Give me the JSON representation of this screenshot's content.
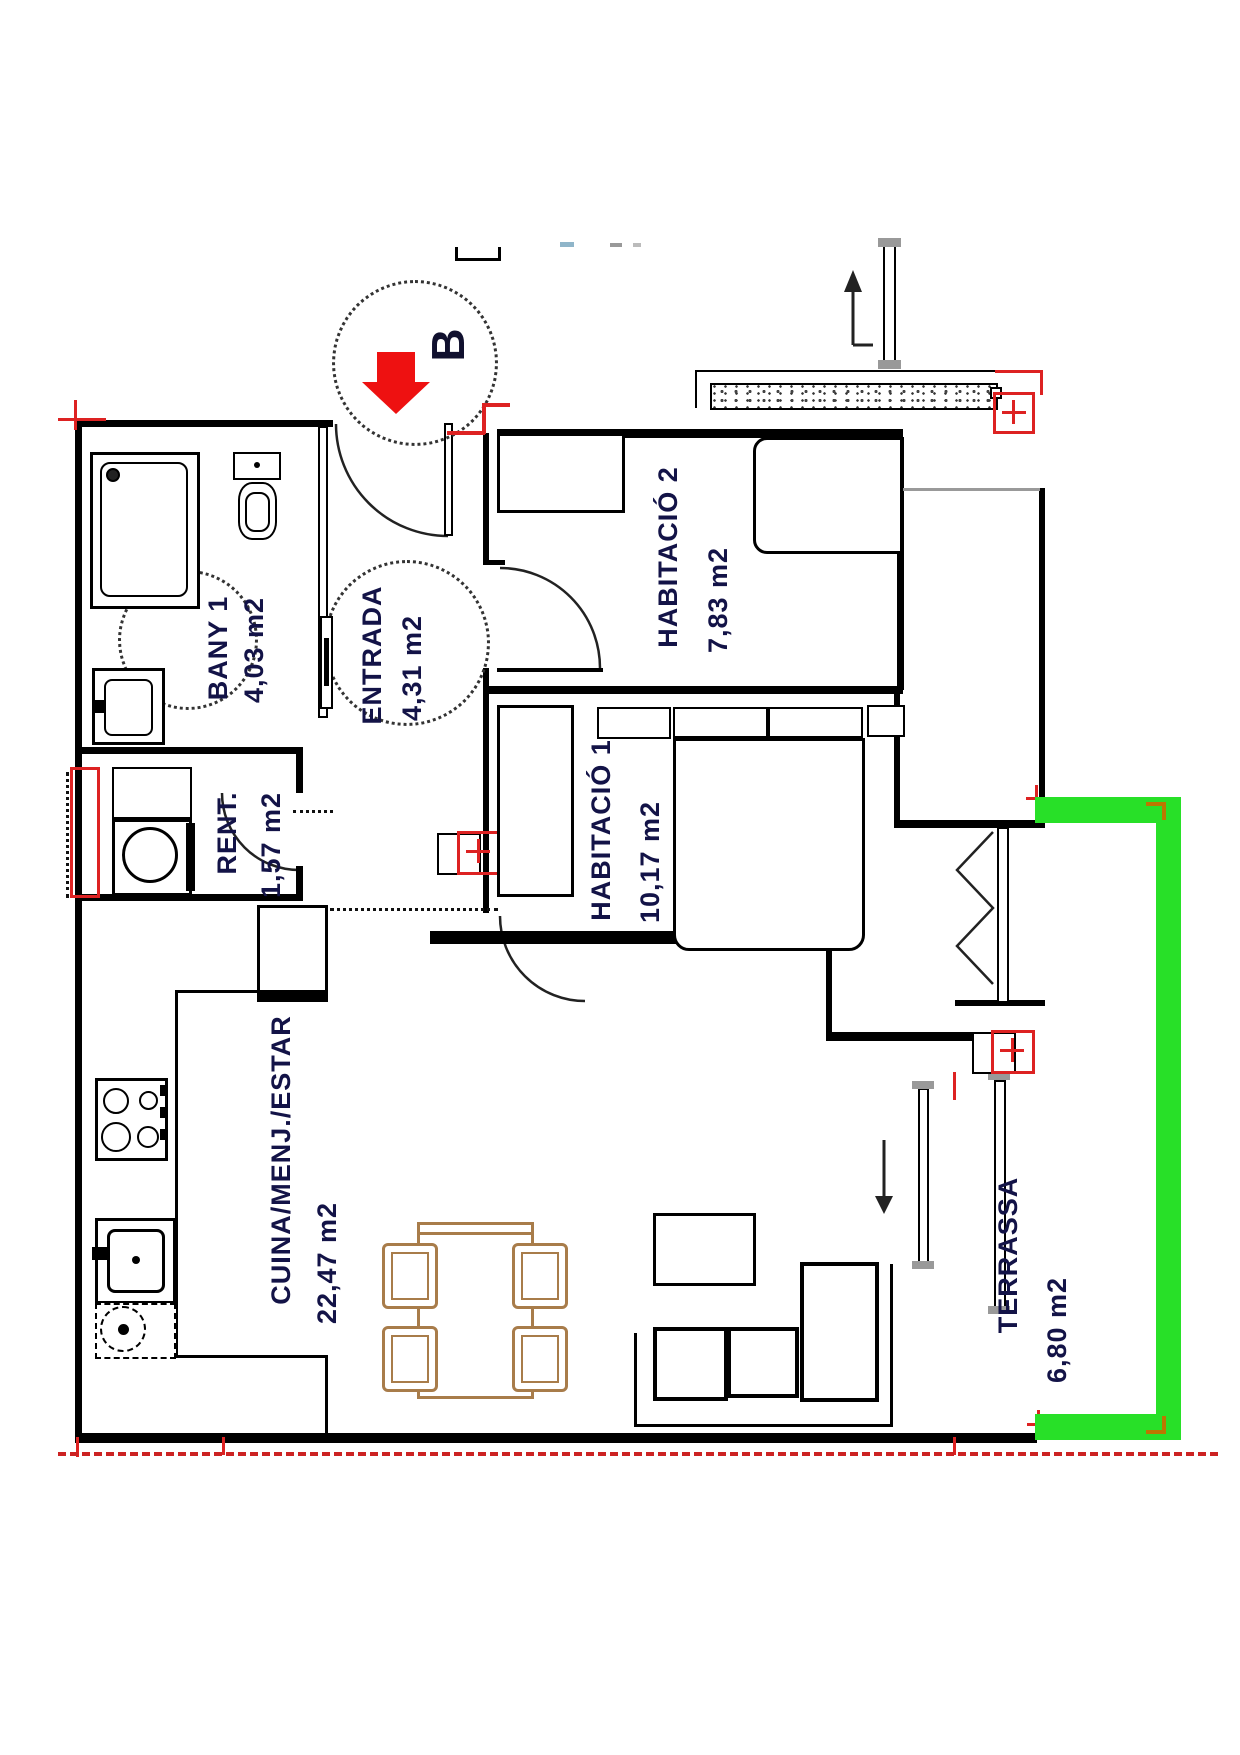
{
  "marker": {
    "letter": "B"
  },
  "rooms": [
    {
      "id": "bany1",
      "name": "BANY 1",
      "area": "4,03 m2"
    },
    {
      "id": "entrada",
      "name": "ENTRADA",
      "area": "4,31 m2"
    },
    {
      "id": "habitacio2",
      "name": "HABITACIÓ 2",
      "area": "7,83 m2"
    },
    {
      "id": "habitacio1",
      "name": "HABITACIÓ 1",
      "area": "10,17 m2"
    },
    {
      "id": "rentador",
      "name": "RENT.",
      "area": "1,57 m2"
    },
    {
      "id": "cuina",
      "name": "CUINA/MENJ./ESTAR",
      "area": "22,47 m2"
    },
    {
      "id": "terrassa",
      "name": "TERRASSA",
      "area": "6,80 m2"
    }
  ],
  "colors": {
    "wall": "#000000",
    "label_text": "#131347",
    "marker_arrow_red": "#ee1111",
    "highlight_red": "#dd2222",
    "terrace_green": "#28e028",
    "furniture_wood": "#a87c4a",
    "boundary_dashed_red": "#cc2222",
    "stipple_gray": "#444444"
  }
}
